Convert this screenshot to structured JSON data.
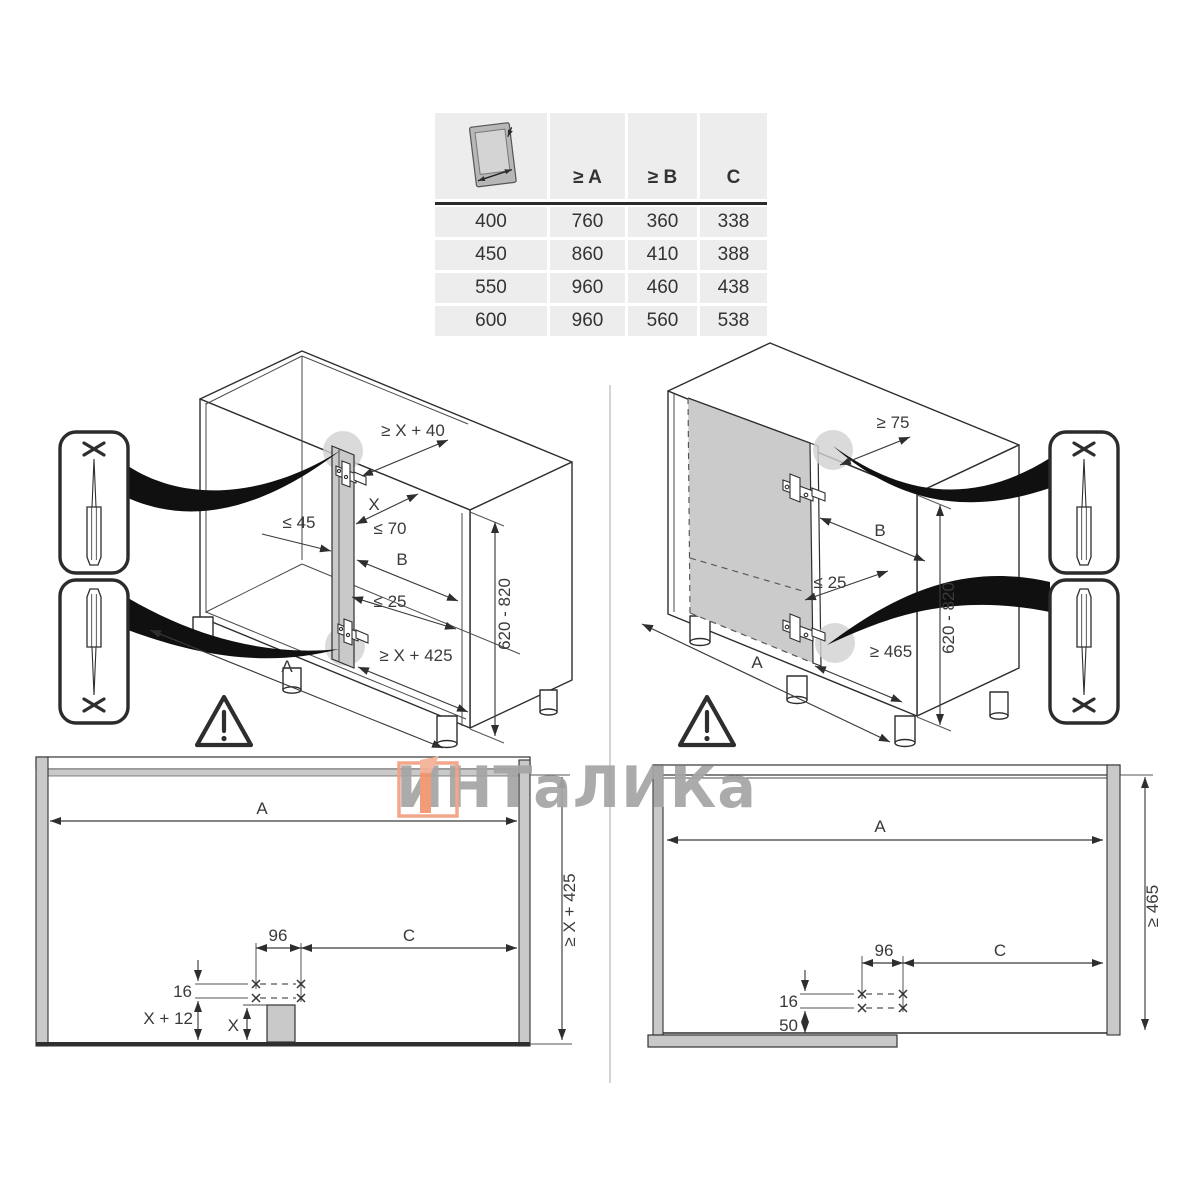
{
  "table": {
    "header": {
      "icon": "door-width-icon",
      "a": "≥ A",
      "b": "≥ B",
      "c": "C"
    },
    "rows": [
      {
        "size": "400",
        "a": "760",
        "b": "360",
        "c": "338"
      },
      {
        "size": "450",
        "a": "860",
        "b": "410",
        "c": "388"
      },
      {
        "size": "550",
        "a": "960",
        "b": "460",
        "c": "438"
      },
      {
        "size": "600",
        "a": "960",
        "b": "560",
        "c": "538"
      }
    ]
  },
  "iso_left": {
    "labels": {
      "top_clearance": "≥ X + 40",
      "x": "X",
      "max_70": "≤ 70",
      "max_45": "≤ 45",
      "b": "B",
      "max_25": "≤ 25",
      "bottom_clearance": "≥ X + 425",
      "a": "A",
      "height_range": "620 - 820"
    }
  },
  "iso_right": {
    "labels": {
      "top_clearance": "≥ 75",
      "b": "B",
      "max_25": "≤ 25",
      "bottom_clearance": "≥ 465",
      "a": "A",
      "height_range": "620 - 820"
    }
  },
  "front_left": {
    "labels": {
      "a": "A",
      "height_min": "≥ X + 425",
      "hole_spacing": "96",
      "c": "C",
      "row_gap": "16",
      "x_plus_12": "X + 12",
      "x": "X"
    }
  },
  "front_right": {
    "labels": {
      "a": "A",
      "height_min": "≥ 465",
      "hole_spacing": "96",
      "c": "C",
      "row_gap": "16",
      "bottom_offset": "50"
    }
  },
  "watermark": {
    "text": "ИНТаЛИКа"
  },
  "colors": {
    "accent_orange": "#f2946e",
    "line": "#2e2e2e",
    "fill_gray": "#c9c9c9",
    "watermark_gray": "#a5a5a5"
  }
}
